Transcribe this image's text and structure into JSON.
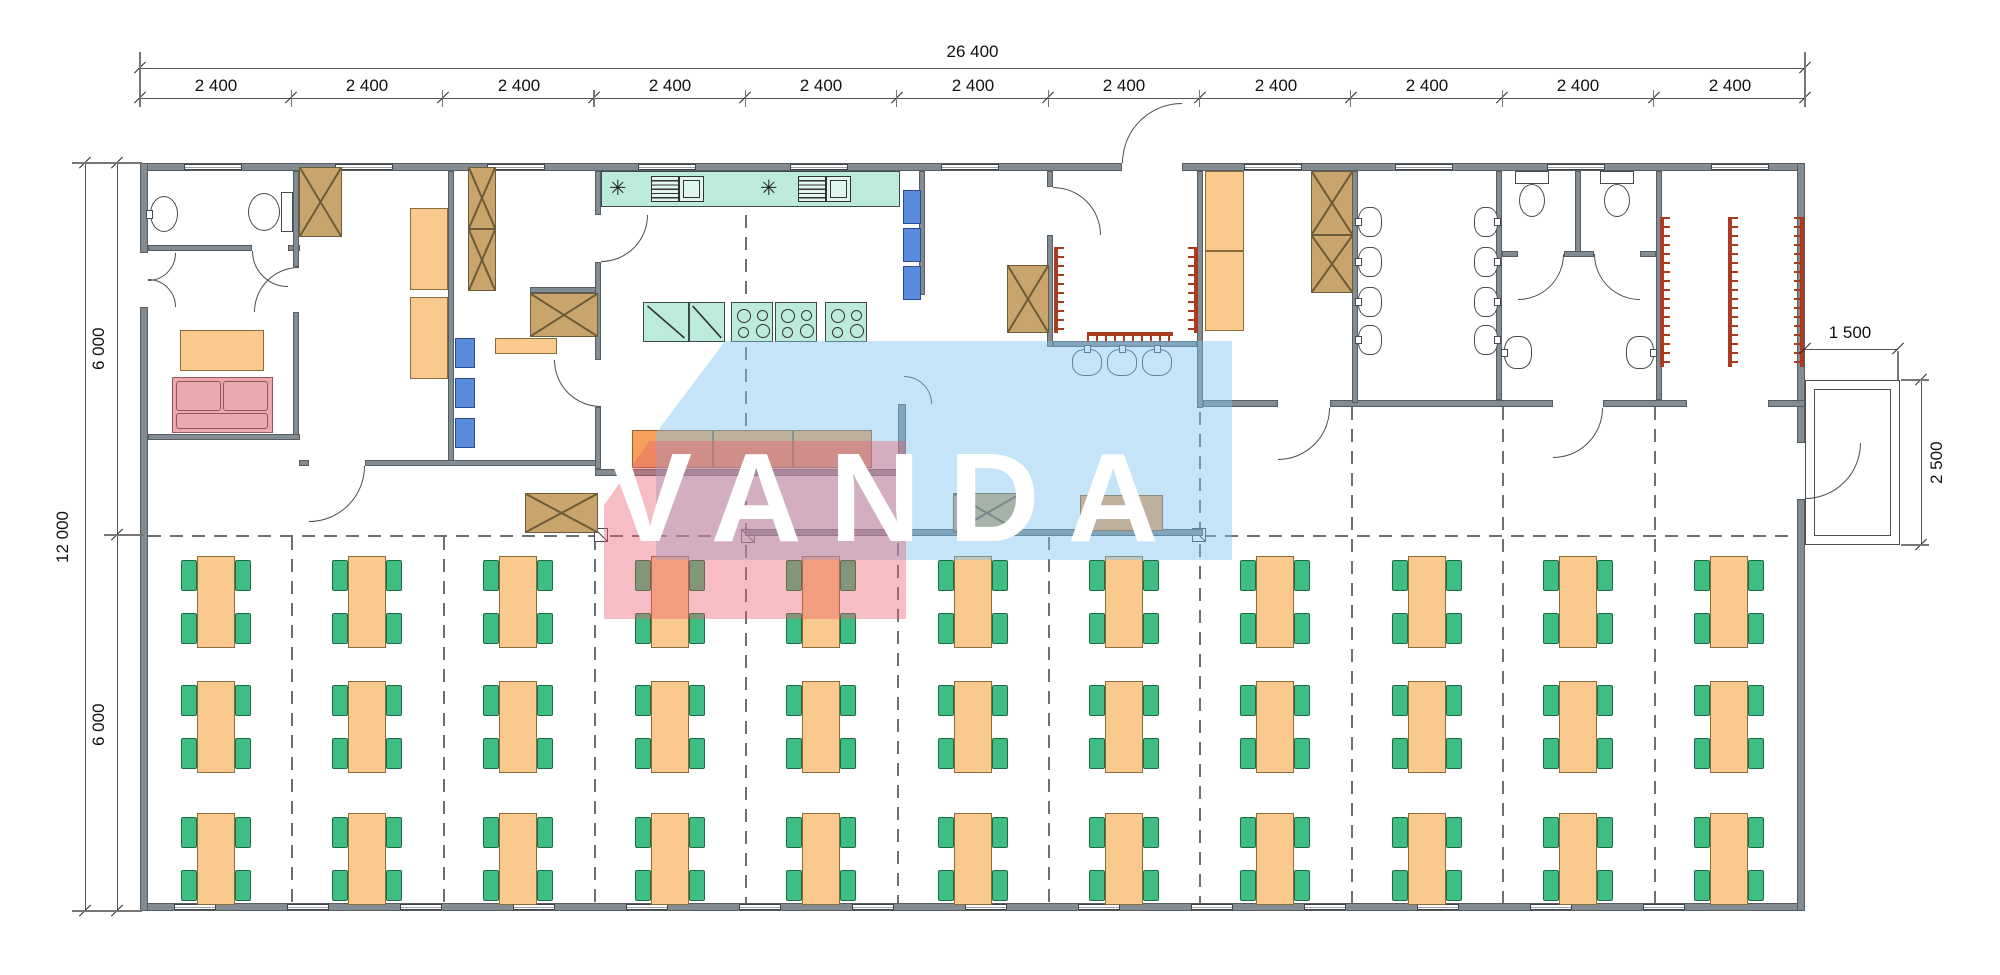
{
  "watermark": {
    "text": "VANDA"
  },
  "dimensions": {
    "top_total": "26 400",
    "top_segment_label": "2 400",
    "top_segment_count": 11,
    "left_total": "12 000",
    "left_upper": "6 000",
    "left_lower": "6 000",
    "porch_width": "1 500",
    "porch_depth": "2 500"
  },
  "kitchen": {
    "fixture_symbol": "✳"
  },
  "dining": {
    "columns": 11,
    "rows": 3
  },
  "colors": {
    "wall": "#848C93",
    "wall_edge": "#565D63",
    "furniture_orange": "#FAC98E",
    "counter_orange": "#F5A05C",
    "cabinet_brown": "#C9A46D",
    "cabinet_edge": "#6E5B37",
    "chair_green": "#3FBE83",
    "chair_edge": "#1D6B46",
    "shelf_blue": "#5B8BDD",
    "shelf_edge": "#2B4D8F",
    "kitchen_teal": "#BCEBDC",
    "sofa_pink": "#E9A9AD",
    "sofa_edge": "#96555B",
    "hooks_red": "#A93C1E",
    "dash_line": "#6A7076",
    "thin_line": "#4A4F54",
    "watermark_pink": "rgba(233,93,108,0.40)",
    "watermark_blue": "rgba(126,196,240,0.45)",
    "watermark_text": "#FFFFFF"
  }
}
